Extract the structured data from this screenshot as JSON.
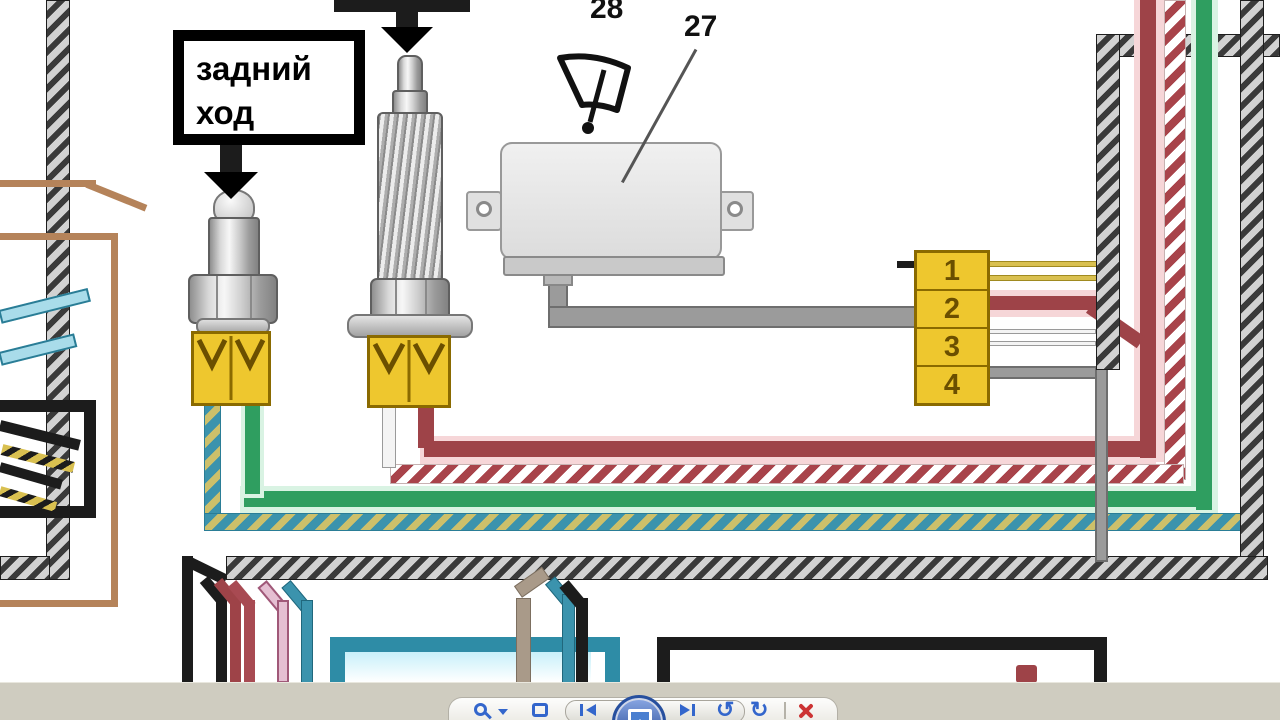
{
  "diagram": {
    "labels": {
      "reverse_line1": "задний",
      "reverse_line2": "ход"
    },
    "callouts": {
      "relay": "27",
      "wiper": "28"
    },
    "connector": {
      "pins": [
        "1",
        "2",
        "3",
        "4"
      ]
    }
  },
  "toolbar": {
    "controls": [
      "zoom",
      "fit-to-window",
      "previous",
      "slideshow",
      "next",
      "rotate-counterclockwise",
      "rotate-clockwise",
      "delete"
    ],
    "rotate_ccw_glyph": "↺",
    "rotate_cw_glyph": "↻"
  },
  "colors": {
    "background": "#ffffff",
    "black": "#1c1c1c",
    "sheath_gray": "#d2d2d2",
    "stripe_black": "#3a3a3a",
    "brown": "#b5835a",
    "teal": "#3b93ad",
    "teal_light": "#a9dcea",
    "green": "#2f9e60",
    "green_glow": "#d9f3e3",
    "dark_red": "#9e4348",
    "red_glow": "#f6d6d8",
    "red_stripe": "#a8434a",
    "yellow": "#d9c050",
    "yellow_stripe": "#cdc06a",
    "gray_cable": "#9b9b9b",
    "taupe": "#a99a89",
    "pink": "#e5bfd2",
    "pink_border": "#a05878",
    "connector_yellow": "#eec72e",
    "connector_border": "#8a6a00",
    "connector_text": "#6b4f00",
    "toolbar_bar": "#cfccc0",
    "toolbar_blue": "#3366cc",
    "x_red": "#cc3333"
  }
}
